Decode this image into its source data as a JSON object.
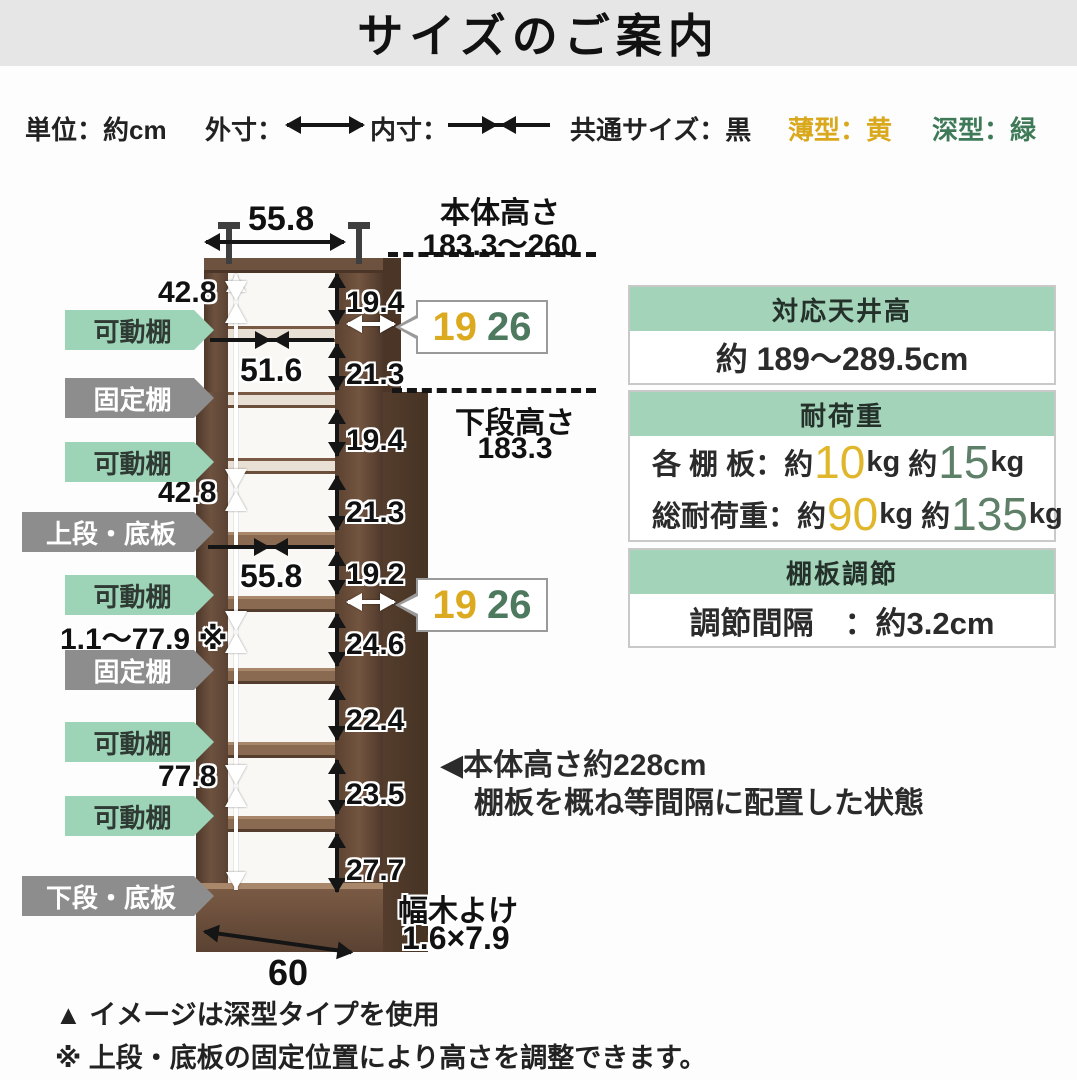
{
  "title": "サイズのご案内",
  "legend": {
    "unit": "単位：約cm",
    "outer_label": "外寸：",
    "inner_label": "内寸：",
    "common": "共通サイズ：黒",
    "thin": "薄型：黄",
    "deep": "深型：緑"
  },
  "colors": {
    "thin_yellow": "#d9a81c",
    "deep_green": "#3f7a58",
    "header_mint": "#a3d3b8",
    "tag_green": "#9dd3b6",
    "tag_gray": "#8d8d8d",
    "wood_brown": "#6e5240"
  },
  "diagram": {
    "top_width": "55.8",
    "upper_inner_width": "51.6",
    "mid_inner_width": "55.8",
    "bottom_width": "60",
    "left_upper_range": "42.8",
    "left_mid_range": "42.8",
    "shelf_adjust_range": "1.1〜77.9 ※",
    "left_lower_range": "77.8",
    "inner_heights": [
      "19.4",
      "21.3",
      "19.4",
      "21.3",
      "19.2",
      "24.6",
      "22.4",
      "23.5",
      "27.7"
    ],
    "body_height_label": "本体高さ",
    "body_height_value": "183.3〜260",
    "lower_height_label": "下段高さ",
    "lower_height_value": "183.3",
    "callout_thin": "19",
    "callout_deep": "26",
    "skirting_label": "幅木よけ",
    "skirting_value": "1.6×7.9",
    "tags": [
      {
        "label": "可動棚",
        "type": "green"
      },
      {
        "label": "固定棚",
        "type": "gray"
      },
      {
        "label": "可動棚",
        "type": "green"
      },
      {
        "label": "上段・底板",
        "type": "gray"
      },
      {
        "label": "可動棚",
        "type": "green"
      },
      {
        "label": "固定棚",
        "type": "gray"
      },
      {
        "label": "可動棚",
        "type": "green"
      },
      {
        "label": "可動棚",
        "type": "green"
      },
      {
        "label": "下段・底板",
        "type": "gray"
      }
    ],
    "annotation_line1": "◀本体高さ約228cm",
    "annotation_line2": "棚板を概ね等間隔に配置した状態"
  },
  "info_boxes": [
    {
      "header": "対応天井高",
      "value": "約 189〜289.5cm"
    },
    {
      "header": "耐荷重",
      "prefix": "：約",
      "mid": "約",
      "unit": "kg",
      "rows": [
        {
          "label": "各 棚 板",
          "thin": "10",
          "deep": "15"
        },
        {
          "label": "総耐荷重",
          "thin": "90",
          "deep": "135"
        }
      ]
    },
    {
      "header": "棚板調節",
      "value": "調節間隔　：約3.2cm"
    }
  ],
  "notes": [
    "▲ イメージは深型タイプを使用",
    "※ 上段・底板の固定位置により高さを調整できます。"
  ]
}
